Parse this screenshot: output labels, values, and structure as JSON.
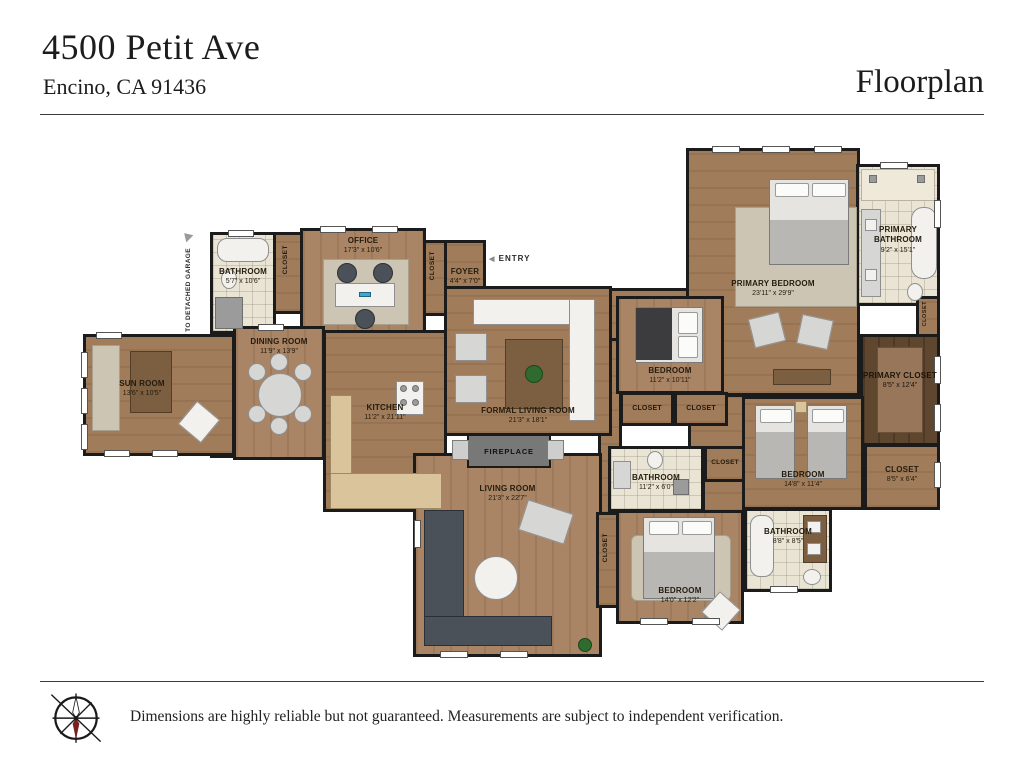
{
  "header": {
    "address_line1": "4500 Petit Ave",
    "address_line2": "Encino, CA 91436",
    "page_label": "Floorplan"
  },
  "labels": {
    "closet": "CLOSET",
    "fireplace": "FIREPLACE",
    "entry": "ENTRY",
    "garage": "TO DETACHED GARAGE"
  },
  "rooms": {
    "office": {
      "name": "OFFICE",
      "dims": "17'3\" x 10'6\""
    },
    "bathroom_tl": {
      "name": "BATHROOM",
      "dims": "5'7\" x 10'6\""
    },
    "foyer": {
      "name": "FOYER",
      "dims": "4'4\" x 7'0\""
    },
    "dining": {
      "name": "DINING ROOM",
      "dims": "11'9\" x 13'9\""
    },
    "sunroom": {
      "name": "SUN ROOM",
      "dims": "13'6\" x 10'5\""
    },
    "kitchen": {
      "name": "KITCHEN",
      "dims": "11'2\" x 21'11\""
    },
    "formal_living": {
      "name": "FORMAL LIVING ROOM",
      "dims": "21'3\" x 18'1\""
    },
    "living": {
      "name": "LIVING ROOM",
      "dims": "21'3\" x 22'7\""
    },
    "primary_bedroom": {
      "name": "PRIMARY BEDROOM",
      "dims": "23'11\" x 29'9\""
    },
    "primary_bathroom": {
      "name": "PRIMARY BATHROOM",
      "dims": "9'2\" x 15'1\""
    },
    "bedroom_mid": {
      "name": "BEDROOM",
      "dims": "11'2\" x 10'11\""
    },
    "bathroom_mid": {
      "name": "BATHROOM",
      "dims": "11'2\" x 6'0\""
    },
    "bedroom_right": {
      "name": "BEDROOM",
      "dims": "14'8\" x 11'4\""
    },
    "primary_closet": {
      "name": "PRIMARY CLOSET",
      "dims": "8'5\" x 12'4\""
    },
    "closet_br": {
      "name": "CLOSET",
      "dims": "8'5\" x 6'4\""
    },
    "bedroom_bottom": {
      "name": "BEDROOM",
      "dims": "14'0\" x 12'2\""
    },
    "bathroom_br": {
      "name": "BATHROOM",
      "dims": "8'8\" x 8'5\""
    }
  },
  "footer": {
    "disclaimer": "Dimensions are highly reliable but not guaranteed. Measurements are subject to independent verification.",
    "compass_icon": "compass-rose-icon"
  },
  "colors": {
    "wall": "#1b1b1b",
    "wood_floor": "#a07c5b",
    "tile_floor": "#e9e4d4",
    "dark_wood": "#5e462f",
    "counter": "#d9c49c",
    "fireplace": "#787878"
  }
}
